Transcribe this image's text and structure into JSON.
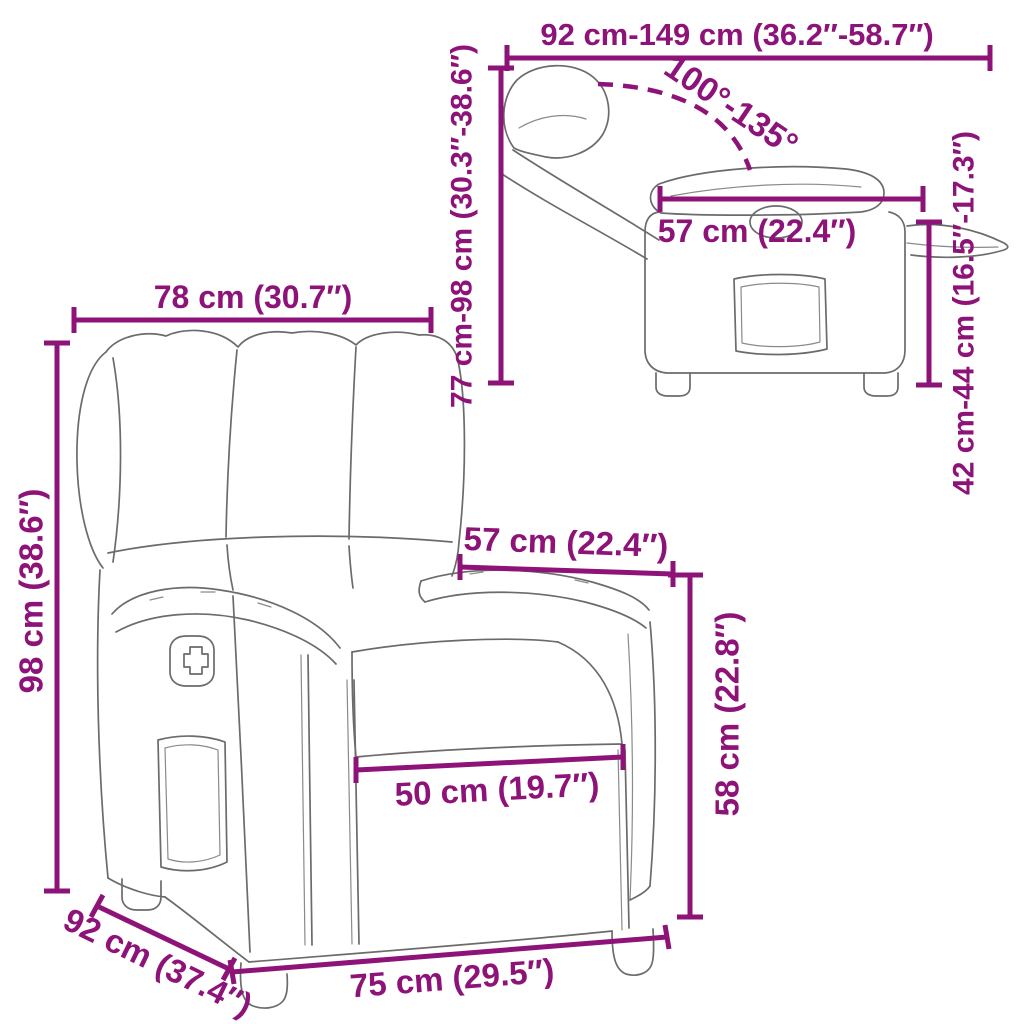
{
  "diagram": {
    "subject": "recliner-chair-dimension-diagram",
    "accent_color": "#8d1379",
    "sketch_line_color": "#6b6b6b",
    "background_color": "#ffffff"
  },
  "labels": {
    "reclined_length_range": "92 cm-149 cm (36.2″-58.7″)",
    "back_height_range": "77 cm-98 cm (30.3″-38.6″)",
    "recline_angle_range": "100°-135°",
    "side_seat_depth": "57 cm (22.4″)",
    "seat_height_range": "42 cm-44 cm (16.5″-17.3″)",
    "total_width": "78 cm (30.7″)",
    "total_height": "98 cm (38.6″)",
    "armrest_span": "57 cm (22.4″)",
    "armrest_height": "58 cm (22.8″)",
    "seat_width": "50 cm (19.7″)",
    "depth": "92 cm (37.4″)",
    "base_width": "75 cm (29.5″)"
  }
}
